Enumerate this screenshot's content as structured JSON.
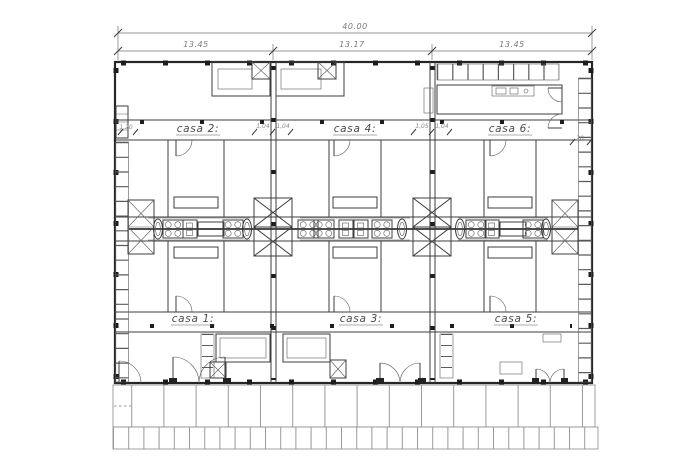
{
  "drawing": {
    "dimensions": {
      "overall": "40.00",
      "segments": [
        "13.45",
        "13.17",
        "13.45"
      ]
    },
    "casa_labels": {
      "top": [
        "casa 2:",
        "casa 4:",
        "casa 6:"
      ],
      "bottom": [
        "casa 1:",
        "casa 3:",
        "casa 5:"
      ]
    },
    "annotations": {
      "left": "1,20",
      "between_2_4": [
        "1,04",
        "1,04"
      ],
      "between_4_6": [
        "1,05",
        "1,04"
      ],
      "right": "20"
    },
    "colors": {
      "background": "#ffffff",
      "wall": "#262626",
      "line": "#3d3d3d",
      "light_line": "#969696",
      "text": "#4a4a4a"
    }
  }
}
